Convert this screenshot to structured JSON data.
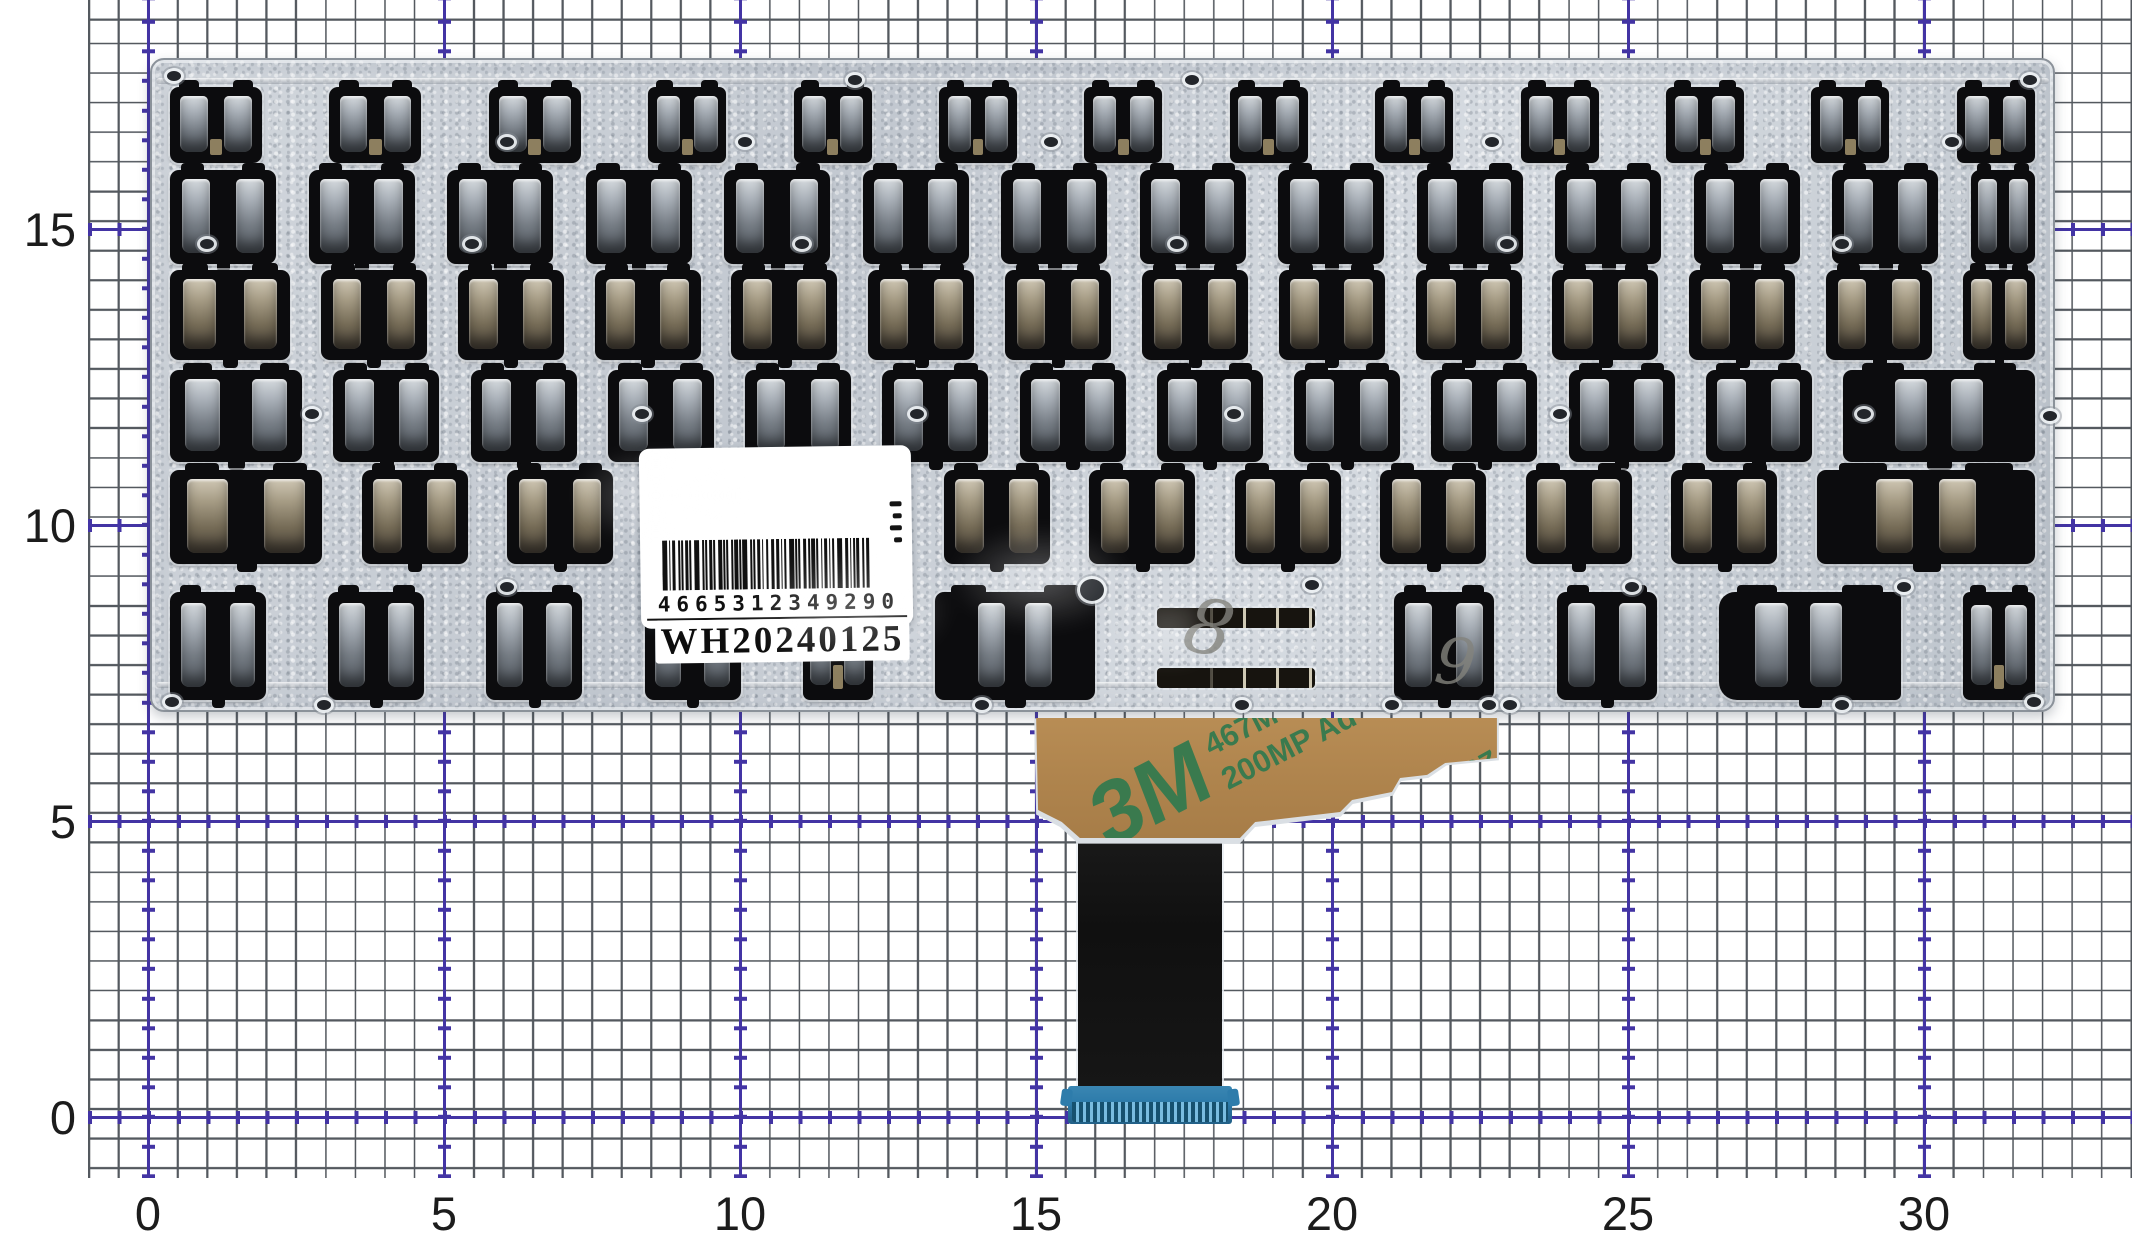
{
  "ruler": {
    "x_ticks": [
      "0",
      "5",
      "10",
      "15",
      "20",
      "25",
      "30"
    ],
    "y_ticks": [
      "0",
      "5",
      "10",
      "15"
    ],
    "unit_px": 59.2,
    "origin_px": {
      "x": 148,
      "y": 1117
    }
  },
  "label": {
    "digits": "4665312349290",
    "serial": "WH20240125"
  },
  "tape": {
    "brand": "3M",
    "code": "467M",
    "type_line": "200MP Ad",
    "code_back": "467MP",
    "type_line_back": "200MP Adhes"
  },
  "marks": {
    "left": "8",
    "right": "9"
  },
  "colors": {
    "grid_minor": "#54595f",
    "grid_major": "#4334a4",
    "plate_silver": "#c8cdd5",
    "cutout_black": "#0c0c0e",
    "tape_tan": "#b0854e",
    "tape_print_green": "#3a7a4e",
    "connector_blue": "#2e7cab",
    "label_white": "#ffffff"
  },
  "plate": {
    "rows": [
      {
        "y": 27,
        "h": 76,
        "u": [
          [
            "fn2",
            92
          ],
          [
            "fn2",
            92
          ],
          [
            "fn2",
            92
          ],
          [
            "fn",
            78
          ],
          [
            "fn",
            78
          ],
          [
            "fn",
            78
          ],
          [
            "fn",
            78
          ],
          [
            "fn",
            78
          ],
          [
            "fn",
            78
          ],
          [
            "fn",
            78
          ],
          [
            "fn",
            78
          ],
          [
            "fn",
            78
          ],
          [
            "fn",
            78
          ]
        ]
      },
      {
        "y": 110,
        "h": 94,
        "u": [
          [
            "std",
            106
          ],
          [
            "std",
            106
          ],
          [
            "std",
            106
          ],
          [
            "std",
            106
          ],
          [
            "std",
            106
          ],
          [
            "std",
            106
          ],
          [
            "std",
            106
          ],
          [
            "std",
            106
          ],
          [
            "std",
            106
          ],
          [
            "std",
            106
          ],
          [
            "std",
            106
          ],
          [
            "std",
            106
          ],
          [
            "std",
            106
          ],
          [
            "nar",
            64
          ]
        ]
      },
      {
        "y": 210,
        "h": 90,
        "u": [
          [
            "std",
            120
          ],
          [
            "std",
            106
          ],
          [
            "std",
            106
          ],
          [
            "std",
            106
          ],
          [
            "std",
            106
          ],
          [
            "std",
            106
          ],
          [
            "std",
            106
          ],
          [
            "std",
            106
          ],
          [
            "std",
            106
          ],
          [
            "std",
            106
          ],
          [
            "std",
            106
          ],
          [
            "std",
            106
          ],
          [
            "std",
            106
          ],
          [
            "nar",
            72
          ]
        ]
      },
      {
        "y": 310,
        "h": 92,
        "u": [
          [
            "std",
            132
          ],
          [
            "std",
            106
          ],
          [
            "std",
            106
          ],
          [
            "std",
            106
          ],
          [
            "std",
            106
          ],
          [
            "std",
            106
          ],
          [
            "std",
            106
          ],
          [
            "std",
            106
          ],
          [
            "std",
            106
          ],
          [
            "std",
            106
          ],
          [
            "std",
            106
          ],
          [
            "std",
            106
          ],
          [
            "bw",
            192
          ]
        ]
      },
      {
        "y": 410,
        "h": 94,
        "u": [
          [
            "std",
            152
          ],
          [
            "std",
            106
          ],
          [
            "std",
            106
          ],
          [
            "std",
            106
          ],
          [
            "std",
            106
          ],
          [
            "std",
            106
          ],
          [
            "std",
            106
          ],
          [
            "std",
            106
          ],
          [
            "std",
            106
          ],
          [
            "std",
            106
          ],
          [
            "std",
            106
          ],
          [
            "bw",
            218
          ]
        ]
      },
      {
        "y": 532,
        "h": 108,
        "u": [
          [
            "std",
            96
          ],
          [
            "std",
            96
          ],
          [
            "std",
            96
          ],
          [
            "std",
            96
          ],
          [
            "fn",
            70
          ],
          [
            "bwS",
            160
          ],
          [
            "slot",
            175
          ],
          [
            "std",
            100
          ],
          [
            "std",
            100
          ],
          [
            "bwA",
            182
          ],
          [
            "fn",
            72
          ]
        ]
      }
    ],
    "warm_rows": [
      2,
      4
    ]
  }
}
